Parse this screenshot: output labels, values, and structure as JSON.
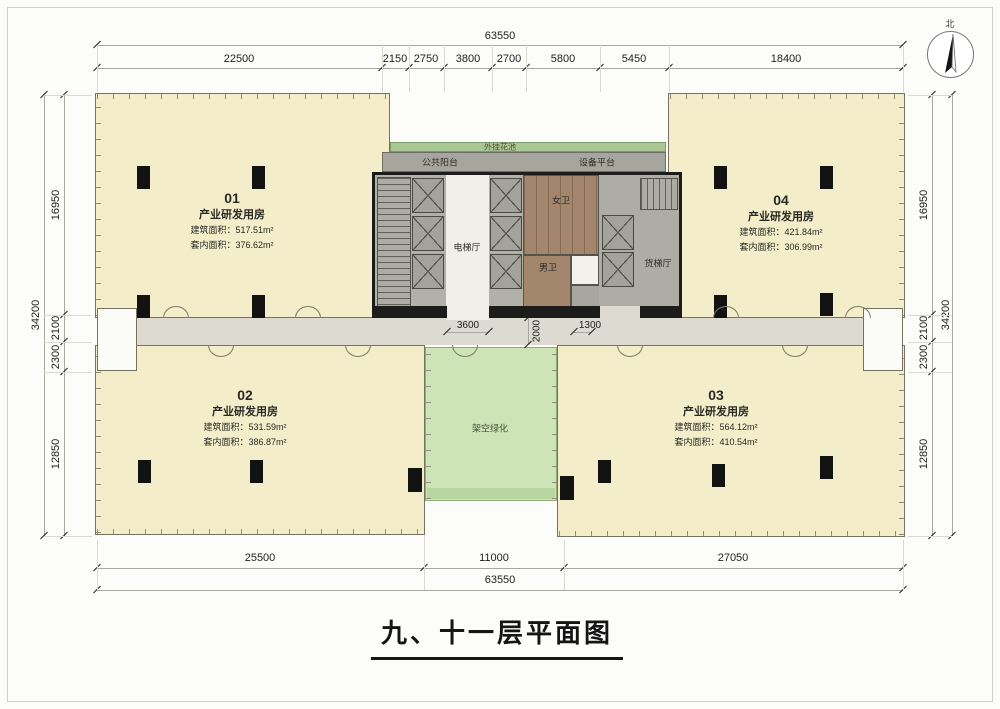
{
  "title": "九、十一层平面图",
  "compass": {
    "north": "北"
  },
  "dims": {
    "top_total": "63550",
    "top_segments": [
      "22500",
      "2150",
      "2750",
      "3800",
      "2700",
      "5800",
      "5450",
      "18400"
    ],
    "left_total": "34200",
    "left_segments": [
      "16950",
      "2100",
      "2300",
      "12850"
    ],
    "right_total": "34200",
    "right_segments": [
      "16950",
      "2100",
      "2300",
      "12850"
    ],
    "bottom_segments": [
      "25500",
      "11000",
      "27050"
    ],
    "bottom_total": "63550",
    "inner": [
      "3600",
      "2000",
      "1300"
    ]
  },
  "units": [
    {
      "number": "01",
      "type": "产业研发用房",
      "gross": "建筑面积：517.51m²",
      "net": "套内面积：376.62m²"
    },
    {
      "number": "02",
      "type": "产业研发用房",
      "gross": "建筑面积：531.59m²",
      "net": "套内面积：386.87m²"
    },
    {
      "number": "03",
      "type": "产业研发用房",
      "gross": "建筑面积：564.12m²",
      "net": "套内面积：410.54m²"
    },
    {
      "number": "04",
      "type": "产业研发用房",
      "gross": "建筑面积：421.84m²",
      "net": "套内面积：306.99m²"
    }
  ],
  "core": {
    "planter": "外挂花池",
    "public_balcony": "公共阳台",
    "equipment_platform": "设备平台",
    "womens_wc": "女卫",
    "mens_wc": "男卫",
    "elevator_hall": "电梯厅",
    "freight_hall": "货梯厅",
    "greenery": "架空绿化"
  },
  "colors": {
    "unit_fill": "#f3edca",
    "corridor": "#dcdad1",
    "core_gray": "#b2b1a9",
    "restroom_brown": "#a3866c",
    "greenery_fill": "#cde4b6",
    "planter_strip": "#aac894",
    "wall_black": "#1c1c1a"
  }
}
